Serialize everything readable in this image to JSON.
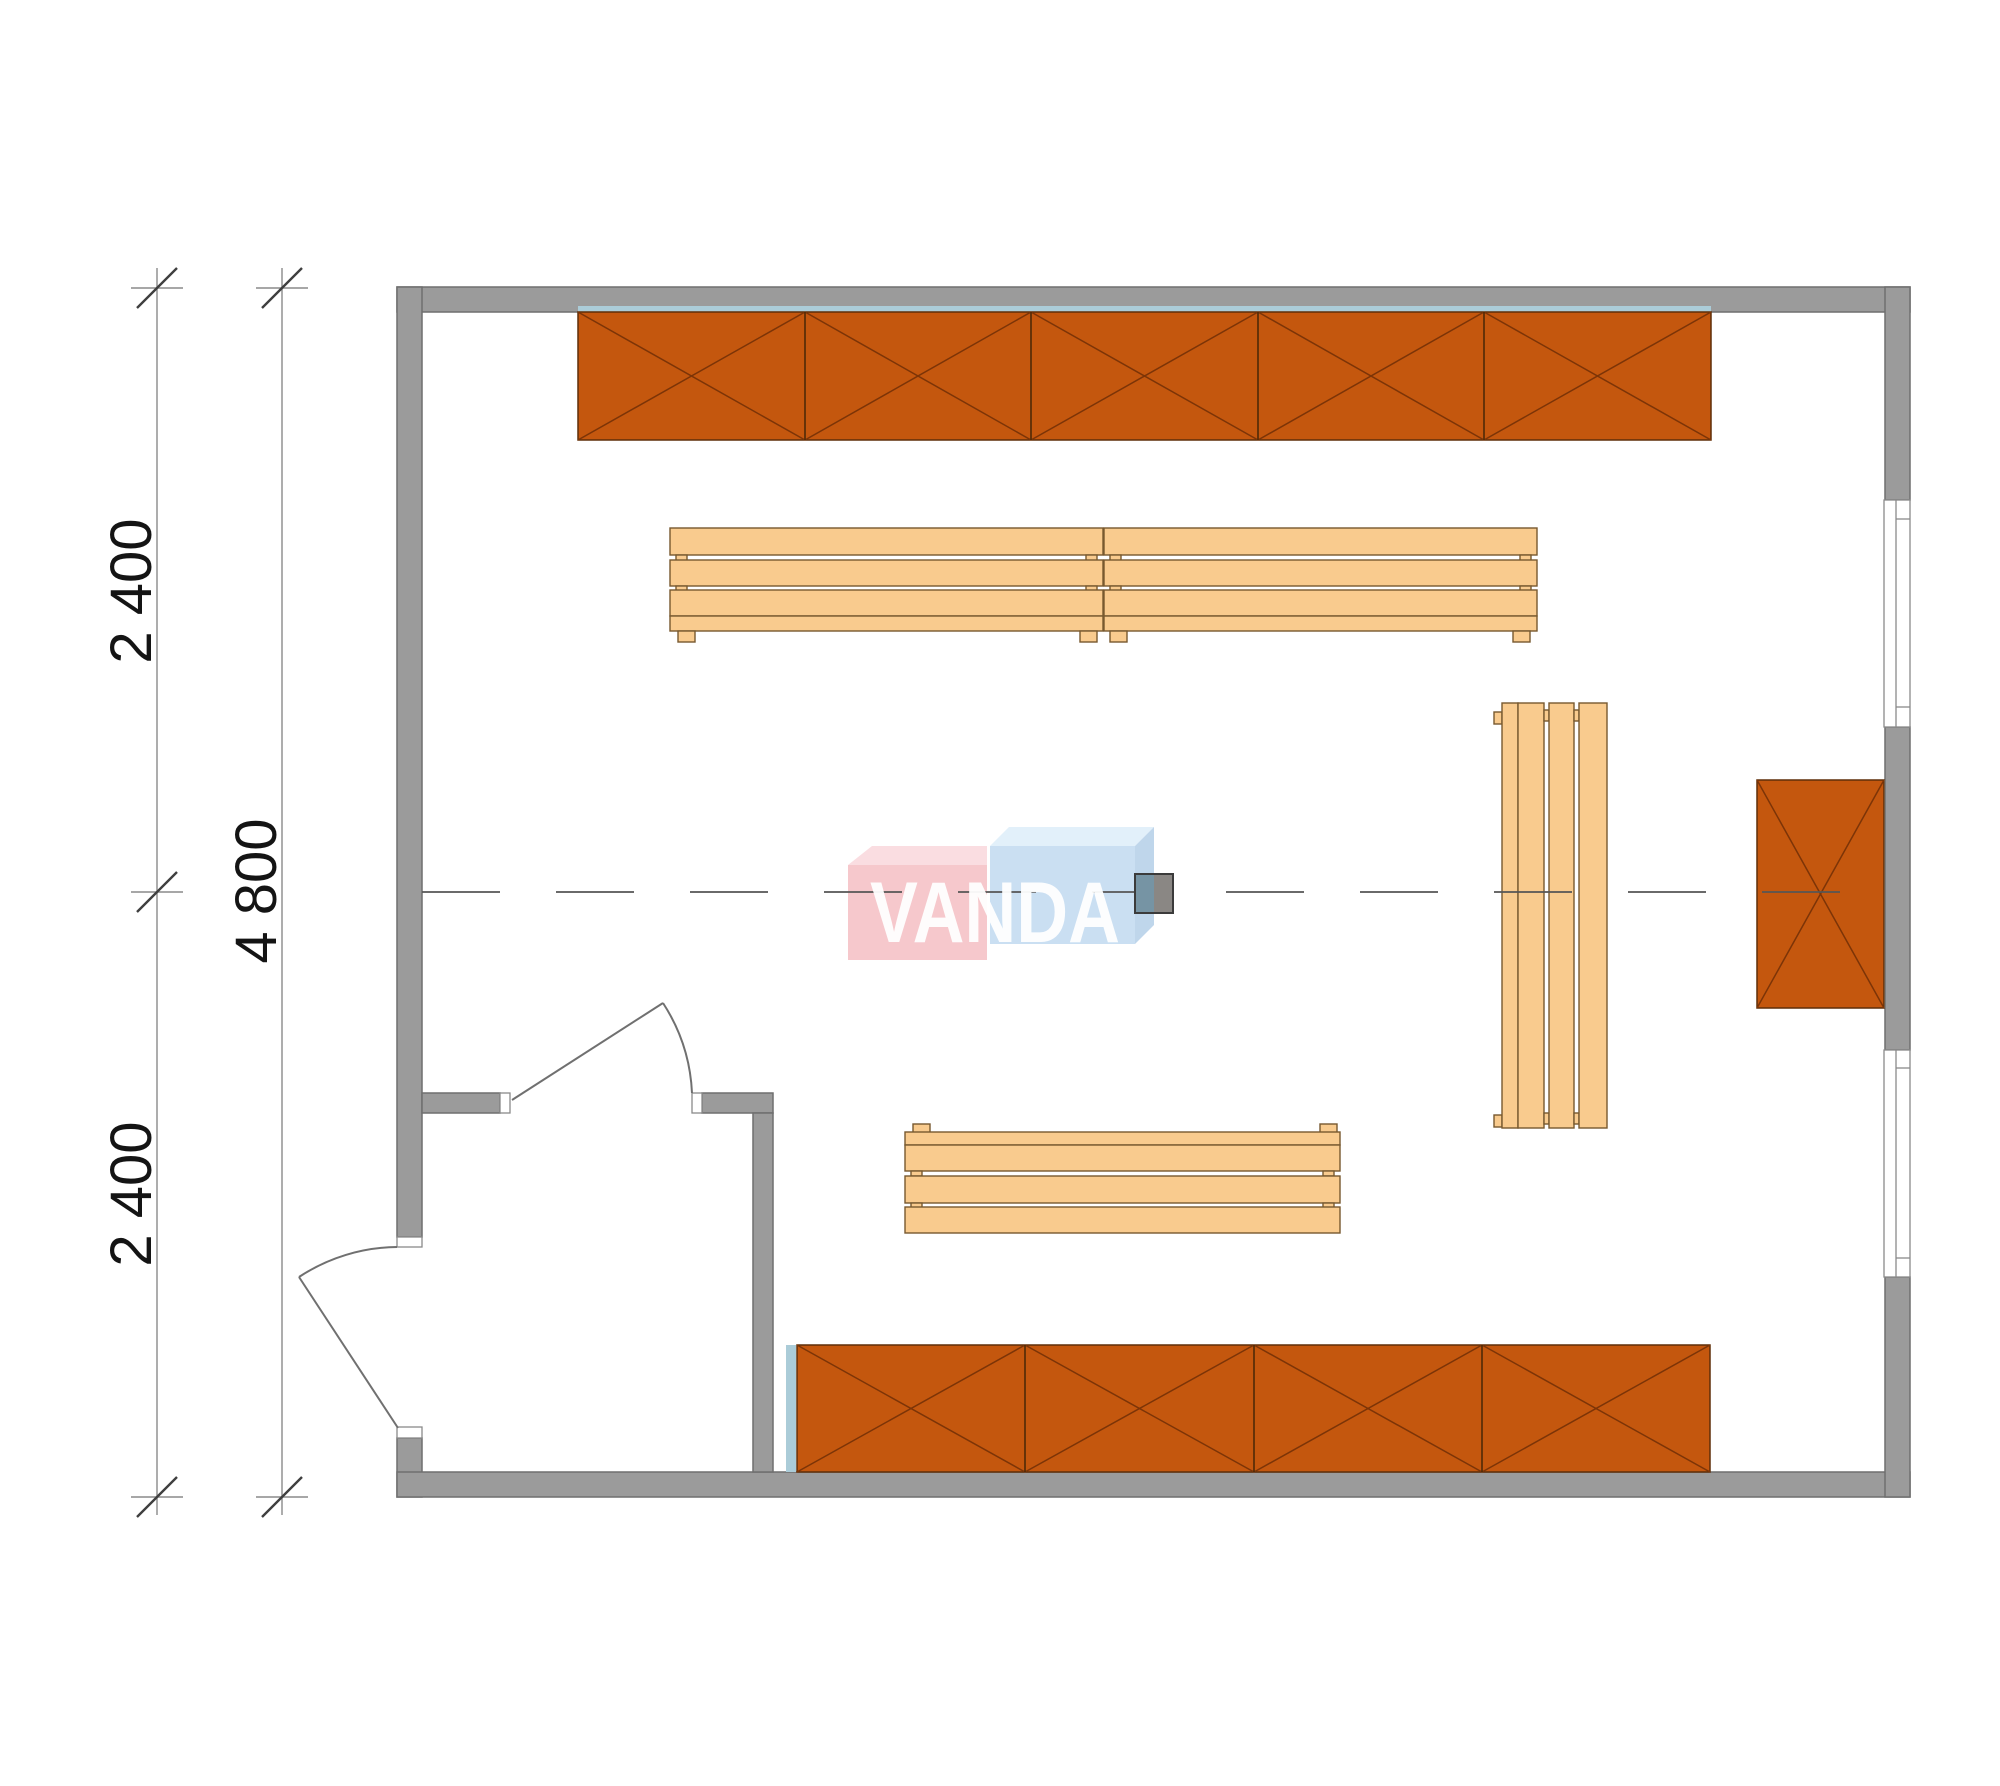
{
  "page": {
    "background": "#ffffff",
    "description": "Floor plan of a rectangular cabin with wall shelves, benches, two doors, two windows and a stove on the centerline"
  },
  "dimensions": {
    "left_inner": {
      "label": "4 800"
    },
    "left_outer_top": {
      "label": "2 400"
    },
    "left_outer_bottom": {
      "label": "2 400"
    }
  },
  "watermark": {
    "text": "VANDA"
  },
  "symbols": {
    "wall": "solid gray wall band",
    "window": "white opening with glazing line and sill caps",
    "door": "quarter-circle swing symbol",
    "shelf": "orange crate with X cross",
    "bench": "three-slat wooden bench",
    "stove": "two-tone square on centerline"
  },
  "colors": {
    "wall_fill": "#9b9b9b",
    "wall_stroke": "#6f6f6f",
    "frame_fill": "#ffffff",
    "frame_stroke": "#8a8a8a",
    "shelf_fill": "#c4570e",
    "shelf_stroke": "#5f2f08",
    "shelf_cross": "#7c3407",
    "shelf_divider": "#4f2a08",
    "bench_fill": "#f9cb8e",
    "bench_stroke": "#77592f",
    "glass_strip": "#abccd8",
    "dim_line": "#8a8a8a",
    "dim_tick": "#3f3f3f",
    "dim_text": "#141414",
    "centerline": "#565656",
    "door_stroke": "#707070",
    "watermark_pink": "#f6c8cc",
    "watermark_pink_top": "#fadde1",
    "watermark_blue": "#cadff2",
    "watermark_blue_top": "#e2f0fa",
    "watermark_blue_side": "#bfd6eb",
    "watermark_text": "#ffffff",
    "stove_left": "#7694a4",
    "stove_right": "#8a8784",
    "stove_stroke": "#3b3b3b"
  }
}
